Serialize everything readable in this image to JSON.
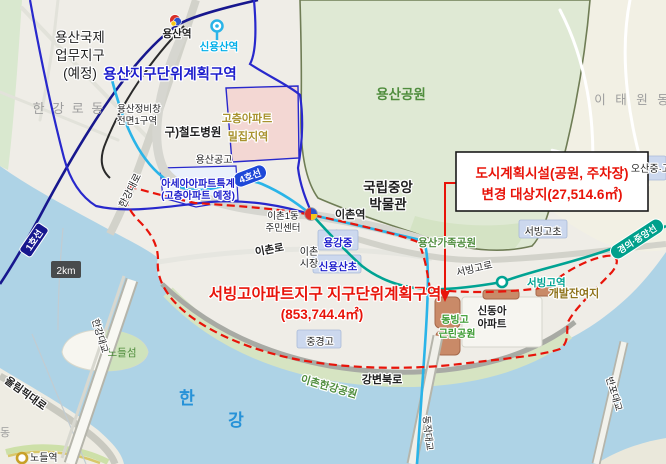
{
  "callout": {
    "line1": "도시계획시설(공원, 주차장)",
    "line2": "변경 대상지(27,514.6㎡)"
  },
  "district_label": {
    "line1": "서빙고아파트지구 지구단위계획구역",
    "line2": "(853,744.4㎡)"
  },
  "zone_labels": {
    "yongsan_district": "용산지구단위계획구역",
    "yongsan_intl_1": "용산국제",
    "yongsan_intl_2": "업무지구",
    "yongsan_intl_3": "(예정)",
    "highrise_1": "고층아파트",
    "highrise_2": "밀집지역",
    "asea_1": "아세아아파트특계",
    "asea_2": "(고층아파트 예정)",
    "jeongbichang_1": "용산정비창",
    "jeongbichang_2": "전면1구역",
    "dev_remnant": "개발잔여지"
  },
  "place_labels": {
    "hangangro_dong": "한 강 로 동",
    "itaewon_dong": "이 태 원 동",
    "yongsan_park": "용산공원",
    "yongsan_family_park": "용산가족공원",
    "museum_1": "국립중앙",
    "museum_2": "박물관",
    "railway_hospital": "구)철도병원",
    "yongsan_gonggo": "용산공고",
    "ichon1dong_1": "이촌1동",
    "ichon1dong_2": "주민센터",
    "ichon_market_1": "이촌",
    "ichon_market_2": "시장",
    "yonggang_middle": "용강중",
    "sinyongsan_elem": "신용산초",
    "junggyeong_high": "중경고",
    "seobinggo_elem": "서빙고초",
    "osan_school": "오산중·고",
    "sindonga_1": "신동아",
    "sindonga_2": "아파트",
    "dongbinggo_1": "동빙고",
    "dongbinggo_2": "근린공원",
    "nodeul_island": "노들섬",
    "han": "한",
    "gang": "강",
    "dong": "동"
  },
  "stations": {
    "yongsan": "용산역",
    "sinyongsan": "신용산역",
    "ichon": "이촌역",
    "seobinggo": "서빙고역",
    "nodeul": "노들역"
  },
  "roads": {
    "hangang_daero": "한강대로",
    "ichon_ro": "이촌로",
    "seobinggo_ro": "서빙고로",
    "gangbyeon_bukro": "강변북로",
    "olympic_daero": "올림픽대로",
    "ichon_hangang_park": "이촌한강공원",
    "hangang_bridge": "한강대교",
    "dongjak_bridge": "동작대교",
    "banpo_bridge": "반포대교"
  },
  "badges": {
    "line1": "1호선",
    "line4": "4호선",
    "gyeongui_jungang": "경의·중앙선",
    "scale": "2km"
  },
  "colors": {
    "water": "#aed3e6",
    "park_green": "#dfe9d4",
    "district_boundary_red": "#e8140a",
    "plan_boundary_blue": "#2828cc",
    "line1_navy": "#17178e",
    "line4_cyan": "#2ab4e8",
    "gyeongui_teal": "#00a393",
    "site_salmon": "#c98a68"
  }
}
